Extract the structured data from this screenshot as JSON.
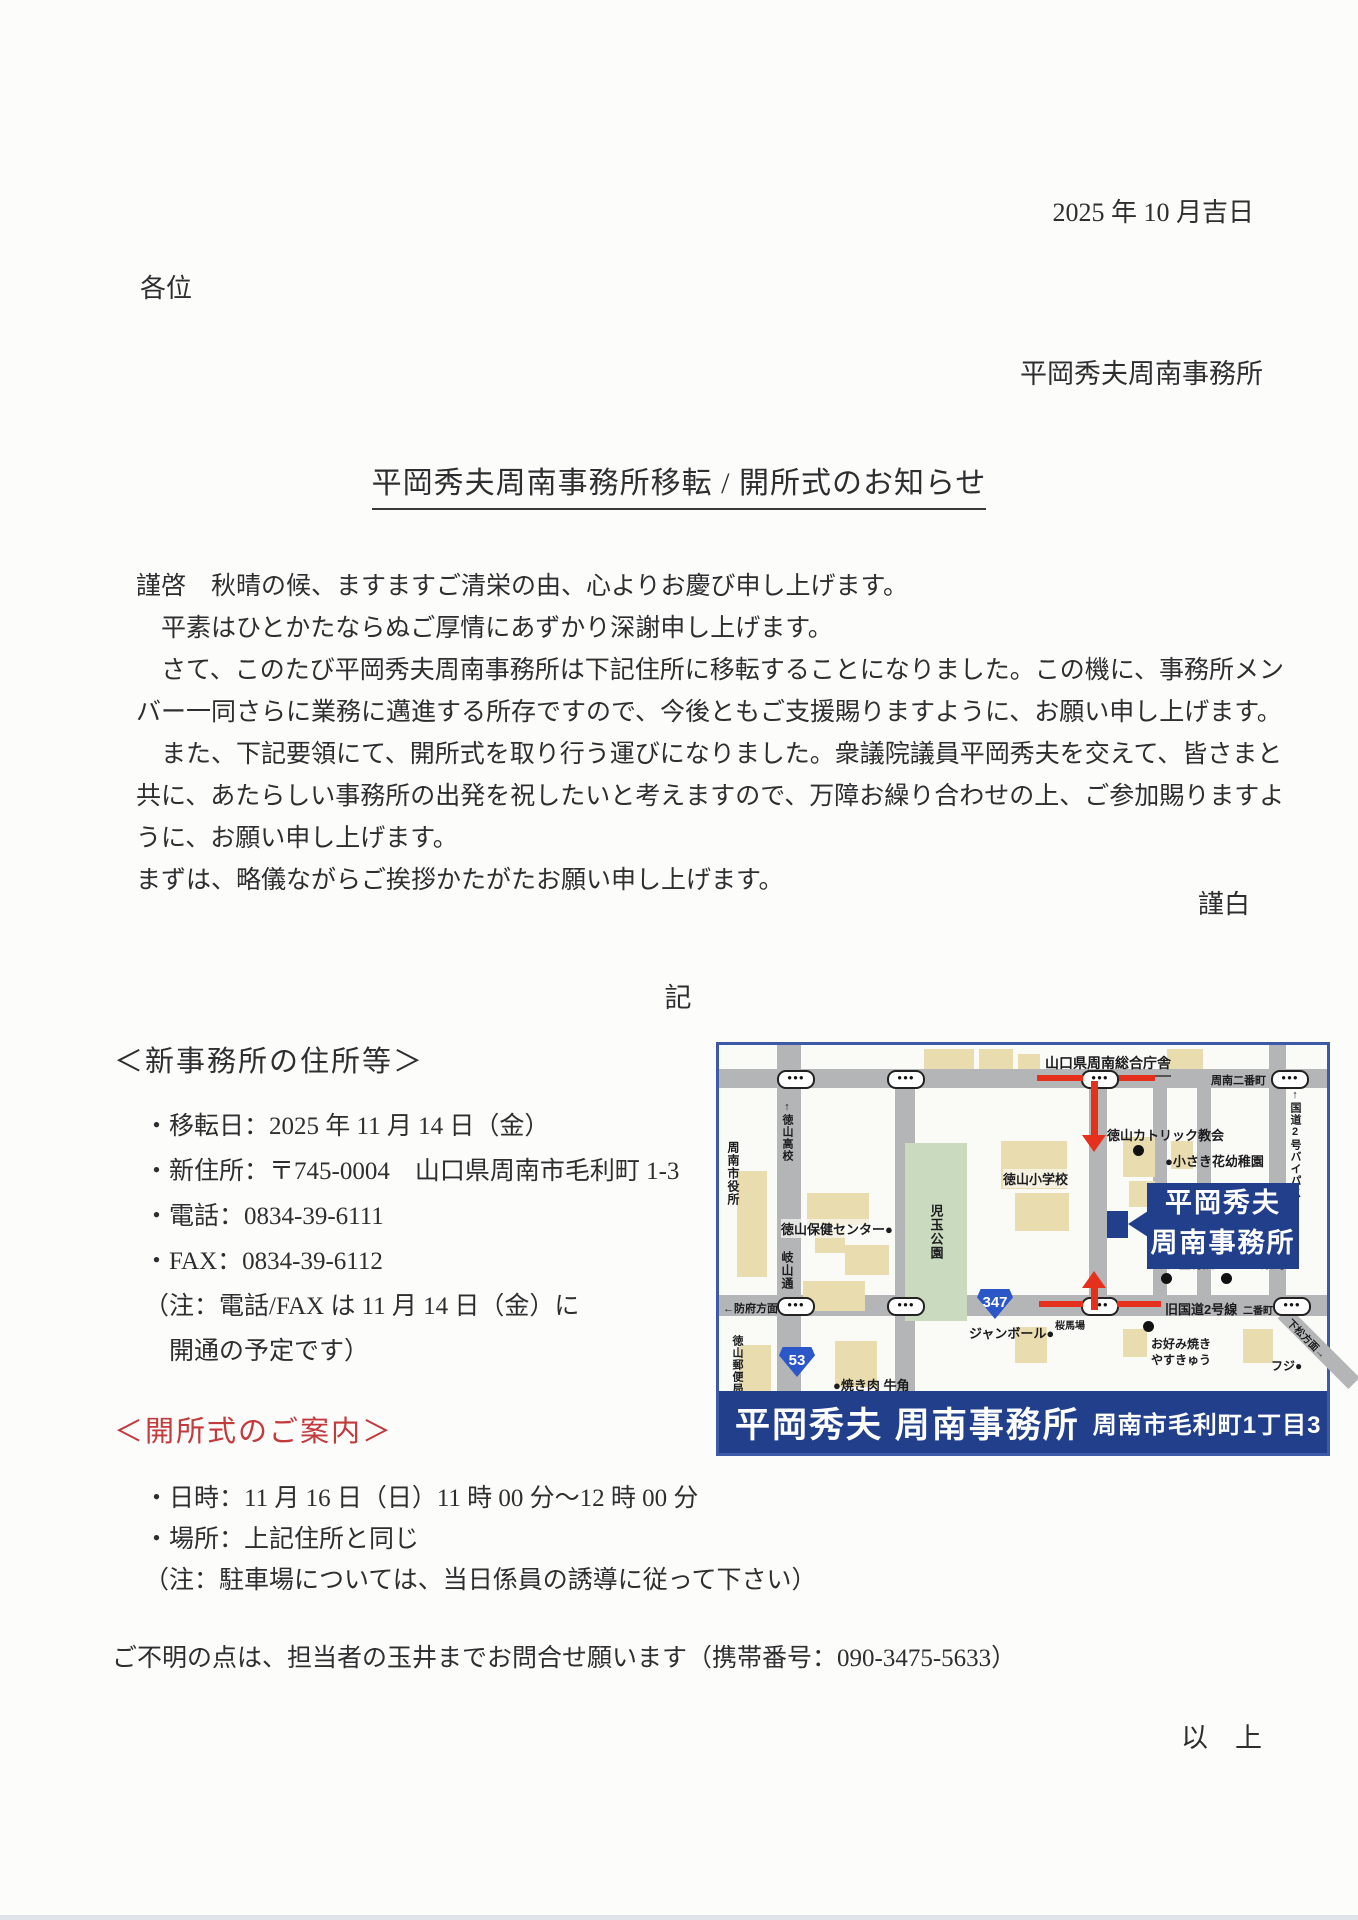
{
  "letter": {
    "date": "2025 年 10 月吉日",
    "addressee": "各位",
    "sender": "平岡秀夫周南事務所",
    "title": "平岡秀夫周南事務所移転 / 開所式のお知らせ",
    "body_lines": [
      "謹啓　秋晴の候、ますますご清栄の由、心よりお慶び申し上げます。",
      "　平素はひとかたならぬご厚情にあずかり深謝申し上げます。",
      "　さて、このたび平岡秀夫周南事務所は下記住所に移転することになりました。この機に、事務所メン",
      "バー一同さらに業務に邁進する所存ですので、今後ともご支援賜りますように、お願い申し上げます。",
      "　また、下記要領にて、開所式を取り行う運びになりました。衆議院議員平岡秀夫を交えて、皆さまと",
      "共に、あたらしい事務所の出発を祝したいと考えますので、万障お繰り合わせの上、ご参加賜りますよ",
      "うに、お願い申し上げます。",
      "まずは、略儀ながらご挨拶かたがたお願い申し上げます。"
    ],
    "closing": "謹白",
    "record_mark": "記",
    "section_address": {
      "heading": "＜新事務所の住所等＞",
      "items": [
        "・移転日：2025 年 11 月 14 日（金）",
        "・新住所：〒745-0004　山口県周南市毛利町 1-3",
        "・電話：0834-39-6111",
        "・FAX：0834-39-6112",
        "（注：電話/FAX は 11 月 14 日（金）に",
        "　開通の予定です）"
      ]
    },
    "section_ceremony": {
      "heading": "＜開所式のご案内＞",
      "items": [
        "・日時：11 月 16 日（日）11 時 00 分～12 時 00 分",
        "・場所：上記住所と同じ",
        "（注：駐車場については、当日係員の誘導に従って下さい）"
      ]
    },
    "footer_note": "ご不明の点は、担当者の玉井までお問合せ願います（携帯番号：090-3475-5633）",
    "end_mark": "以　上"
  },
  "map": {
    "labels": {
      "govt": "山口県周南総合庁舎",
      "nibancho_top": "周南二番町",
      "tokuyama_hs": "↑徳山高校",
      "cityhall": "周南市役所",
      "catholic": "徳山カトリック教会",
      "kindergarten": "●小さき花幼稚園",
      "bypass": "↑国道2号バイパス",
      "health": "徳山保健センター●",
      "gizan": "岐山通",
      "kodama": "児玉公園",
      "elementary": "徳山小学校",
      "rubo": "るぼ整骨院",
      "alice": "アリス薬局",
      "old_r2": "旧国道2号線",
      "nibancho_small": "二番町",
      "hofu": "←防府方面",
      "sakurababa": "桜馬場",
      "post": "徳山郵便局",
      "yakiniku": "●焼き肉 牛角",
      "jumbo": "ジャンボール●",
      "okonomi1": "お好み焼き",
      "okonomi2": "やすきゅう",
      "fuji": "フジ●",
      "kudamatsu": "下松方面→"
    },
    "shields": {
      "r347": "347",
      "r53": "53"
    },
    "traffic_light_glyph": "●●●",
    "callout": {
      "line1": "平岡秀夫",
      "line2": "周南事務所"
    },
    "banner": {
      "office": "平岡秀夫 周南事務所",
      "address": "周南市毛利町1丁目3"
    },
    "colors": {
      "navy": "#223f8c",
      "border_blue": "#3c5aa8",
      "road_gray": "#b4b5b7",
      "building_tan": "#e9dcae",
      "park_green": "#c9dabe",
      "route_red": "#e5301d",
      "heading_red": "#c23a3c"
    }
  }
}
